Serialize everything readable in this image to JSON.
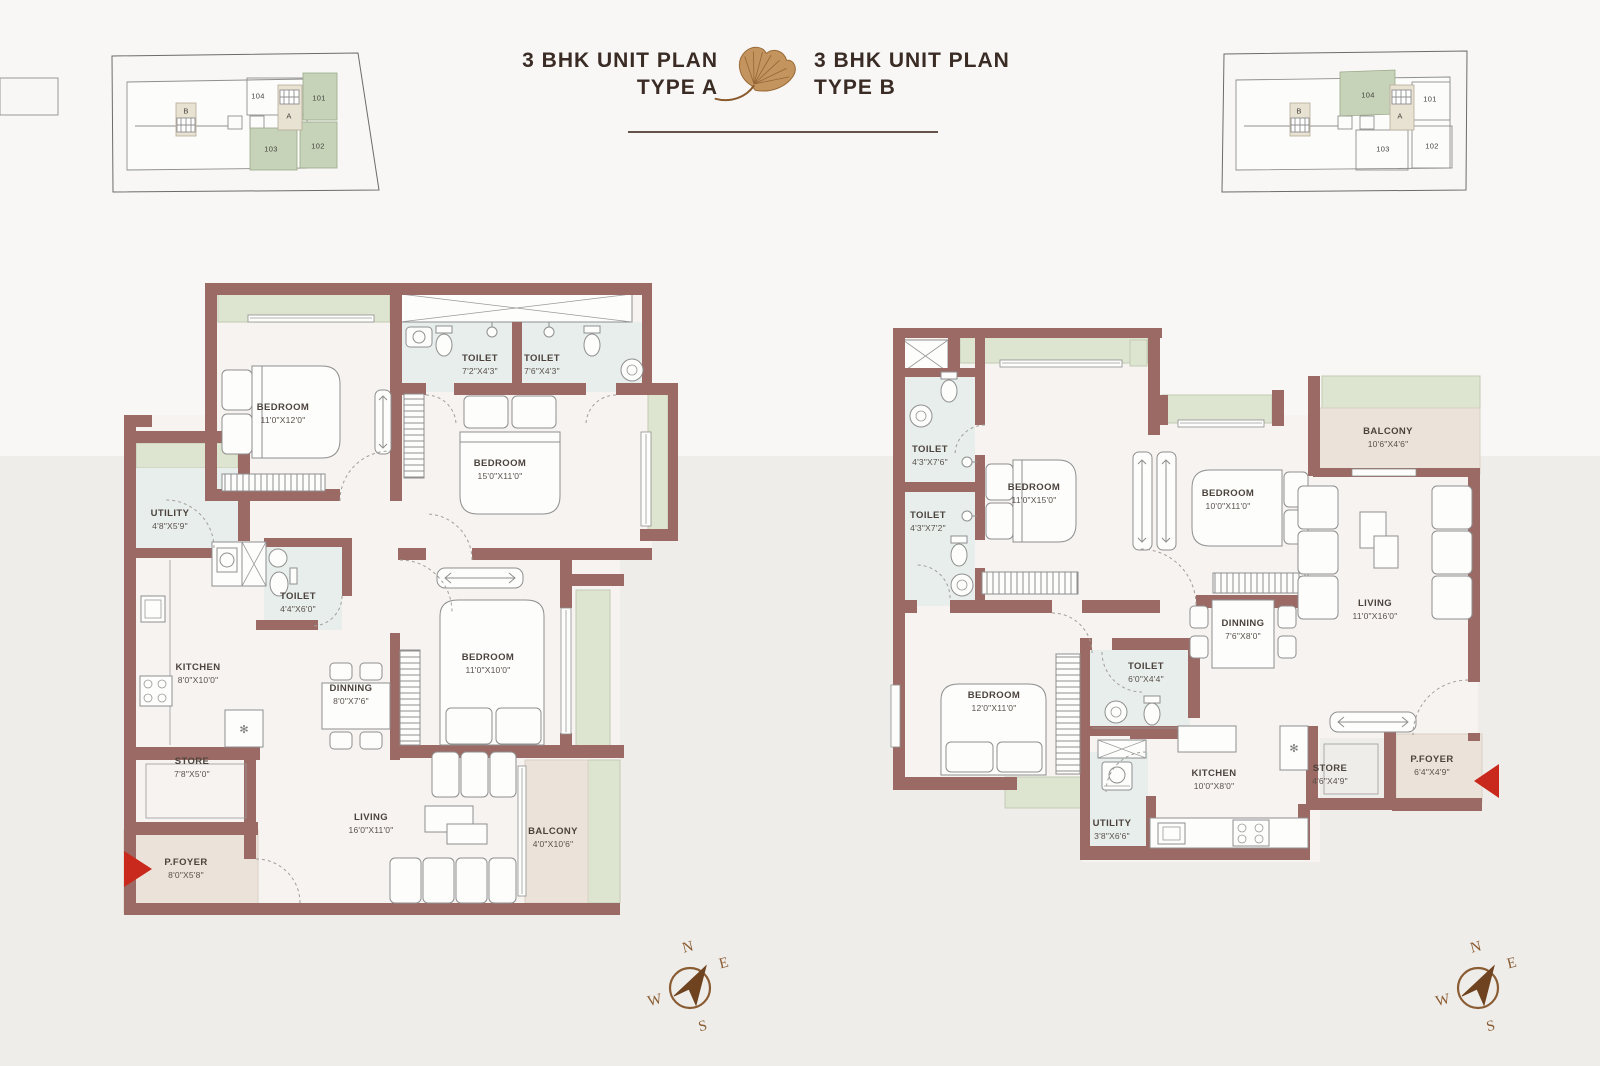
{
  "header": {
    "title_a_line1": "3 BHK UNIT PLAN",
    "title_a_line2": "TYPE A",
    "title_b_line1": "3 BHK UNIT PLAN",
    "title_b_line2": "TYPE B"
  },
  "key_plan_left": {
    "unit_101": "101",
    "unit_102": "102",
    "unit_103": "103",
    "unit_104": "104",
    "unit_a": "A",
    "unit_b": "B"
  },
  "key_plan_right": {
    "unit_101": "101",
    "unit_102": "102",
    "unit_103": "103",
    "unit_104": "104",
    "unit_a": "A",
    "unit_b": "B"
  },
  "plan_a": {
    "rooms": {
      "toilet1": {
        "name": "TOILET",
        "dim": "7'2\"X4'3\""
      },
      "toilet2": {
        "name": "TOILET",
        "dim": "7'6\"X4'3\""
      },
      "bedroom1": {
        "name": "BEDROOM",
        "dim": "11'0\"X12'0\""
      },
      "bedroom2": {
        "name": "BEDROOM",
        "dim": "15'0\"X11'0\""
      },
      "utility": {
        "name": "UTILITY",
        "dim": "4'8\"X5'9\""
      },
      "toilet3": {
        "name": "TOILET",
        "dim": "4'4\"X6'0\""
      },
      "kitchen": {
        "name": "KITCHEN",
        "dim": "8'0\"X10'0\""
      },
      "dinning": {
        "name": "DINNING",
        "dim": "8'0\"X7'6\""
      },
      "bedroom3": {
        "name": "BEDROOM",
        "dim": "11'0\"X10'0\""
      },
      "store": {
        "name": "STORE",
        "dim": "7'8\"X5'0\""
      },
      "living": {
        "name": "LIVING",
        "dim": "16'0\"X11'0\""
      },
      "balcony": {
        "name": "BALCONY",
        "dim": "4'0\"X10'6\""
      },
      "pfoyer": {
        "name": "P.FOYER",
        "dim": "8'0\"X5'8\""
      }
    }
  },
  "plan_b": {
    "rooms": {
      "toilet1": {
        "name": "TOILET",
        "dim": "4'3\"X7'6\""
      },
      "toilet2": {
        "name": "TOILET",
        "dim": "4'3\"X7'2\""
      },
      "bedroom1": {
        "name": "BEDROOM",
        "dim": "11'0\"X15'0\""
      },
      "bedroom2": {
        "name": "BEDROOM",
        "dim": "10'0\"X11'0\""
      },
      "balcony": {
        "name": "BALCONY",
        "dim": "10'6\"X4'6\""
      },
      "living": {
        "name": "LIVING",
        "dim": "11'0\"X16'0\""
      },
      "dinning": {
        "name": "DINNING",
        "dim": "7'6\"X8'0\""
      },
      "toilet3": {
        "name": "TOILET",
        "dim": "6'0\"X4'4\""
      },
      "bedroom3": {
        "name": "BEDROOM",
        "dim": "12'0\"X11'0\""
      },
      "utility": {
        "name": "UTILITY",
        "dim": "3'8\"X6'6\""
      },
      "kitchen": {
        "name": "KITCHEN",
        "dim": "10'0\"X8'0\""
      },
      "store": {
        "name": "STORE",
        "dim": "4'6\"X4'9\""
      },
      "pfoyer": {
        "name": "P.FOYER",
        "dim": "6'4\"X4'9\""
      }
    }
  },
  "compass": {
    "n": "N",
    "e": "E",
    "s": "S",
    "w": "W"
  }
}
